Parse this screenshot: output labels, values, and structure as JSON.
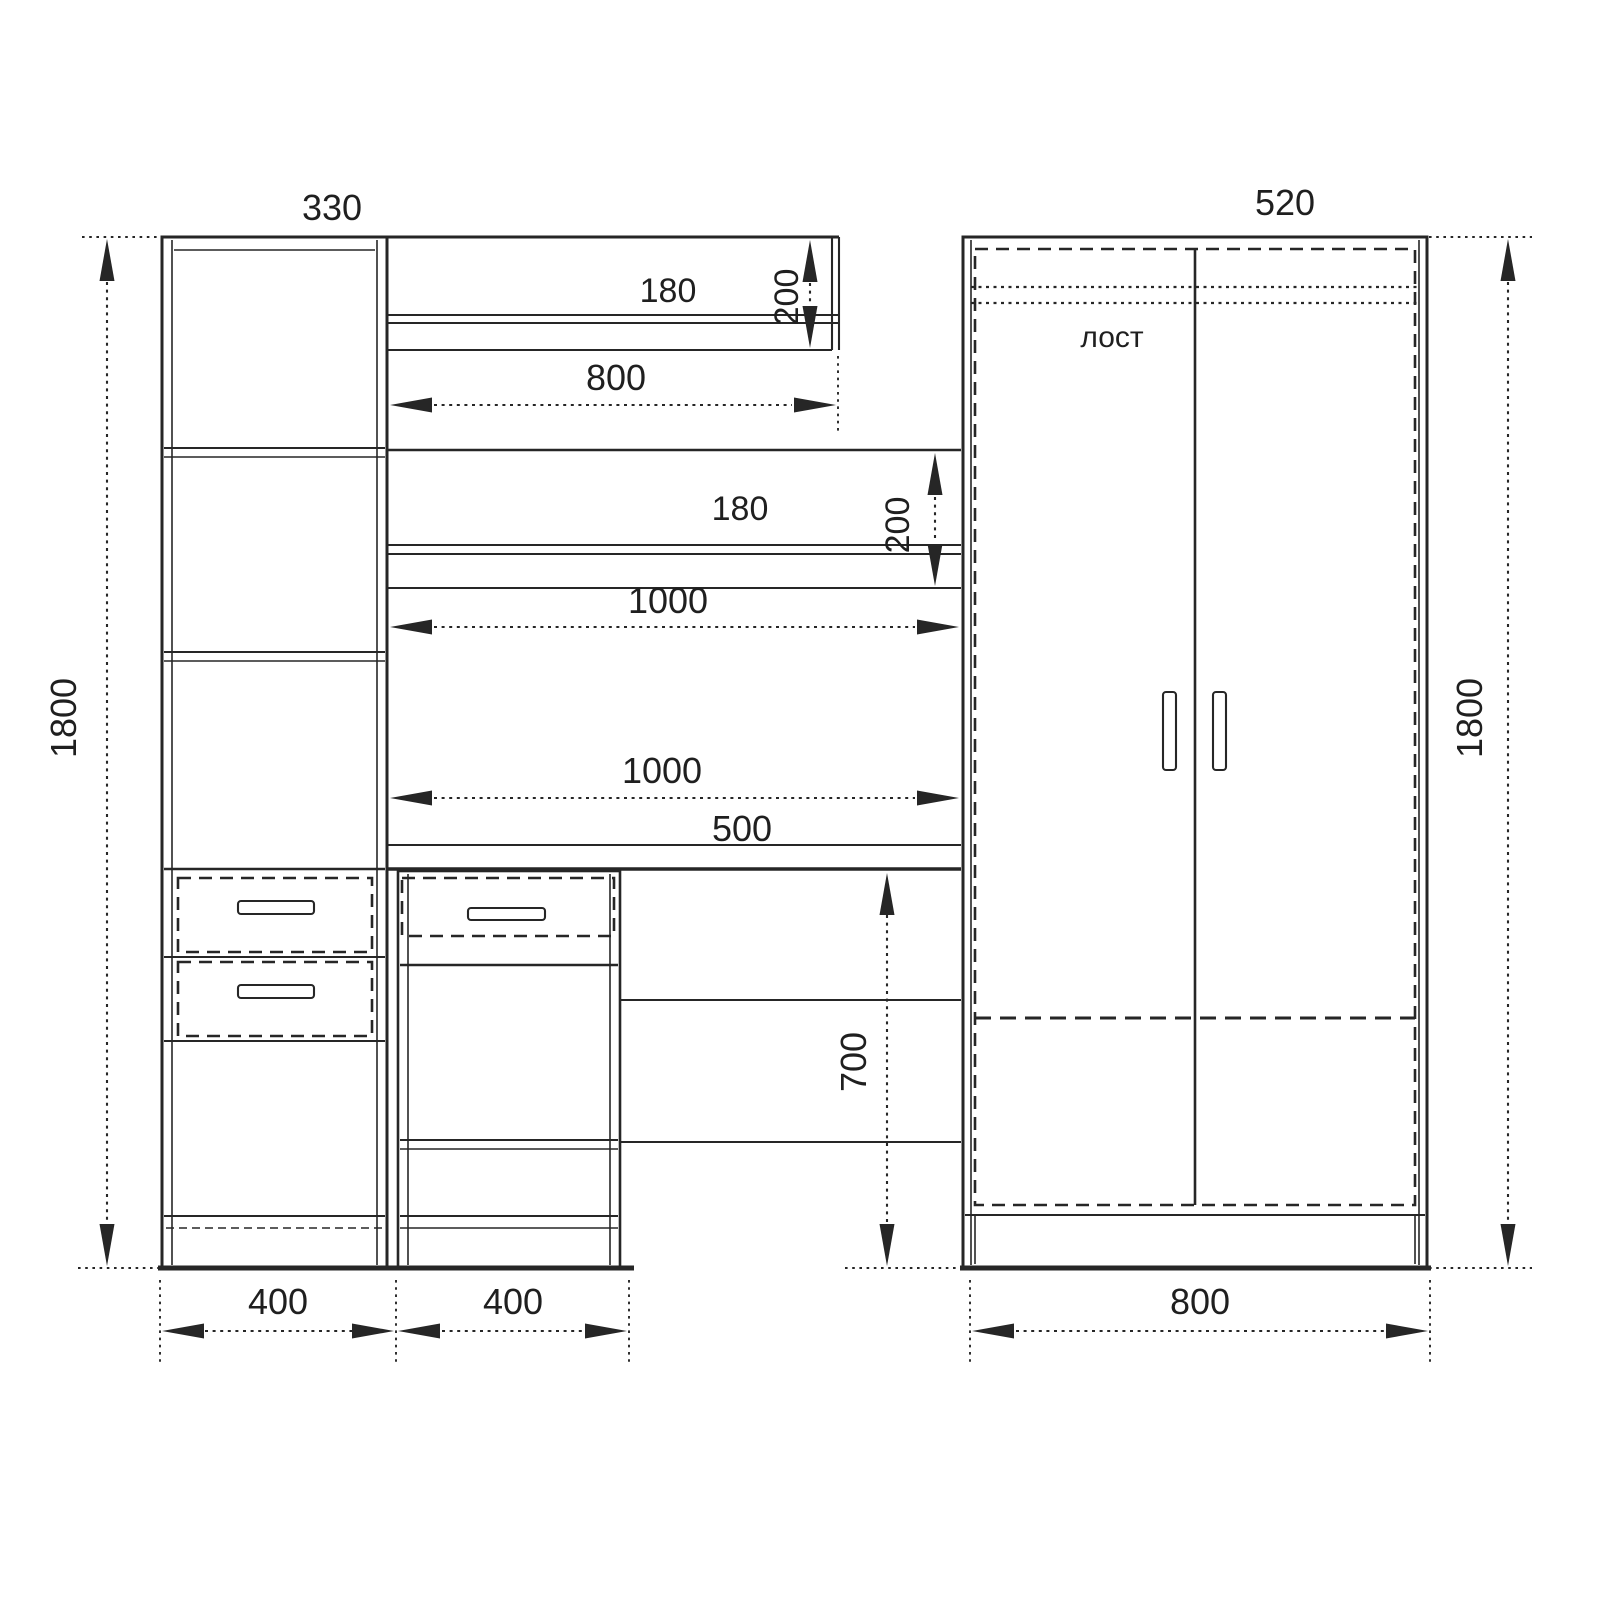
{
  "drawing": {
    "type": "furniture-elevation",
    "colors": {
      "line": "#262626",
      "text": "#1f1f1f",
      "background": "#ffffff"
    },
    "dims": {
      "overall_height_left": "1800",
      "overall_height_right": "1800",
      "cabinet_top_depth": "330",
      "wardrobe_top_depth": "520",
      "shelf_upper": {
        "opening": "180",
        "height": "200",
        "width": "800"
      },
      "shelf_lower": {
        "opening": "180",
        "height": "200",
        "width": "1000"
      },
      "desk": {
        "width": "1000",
        "depth": "500",
        "height": "700"
      },
      "base": {
        "cabinet": "400",
        "pedestal": "400",
        "wardrobe": "800"
      }
    },
    "wardrobe": {
      "interior_label": "лост"
    }
  }
}
